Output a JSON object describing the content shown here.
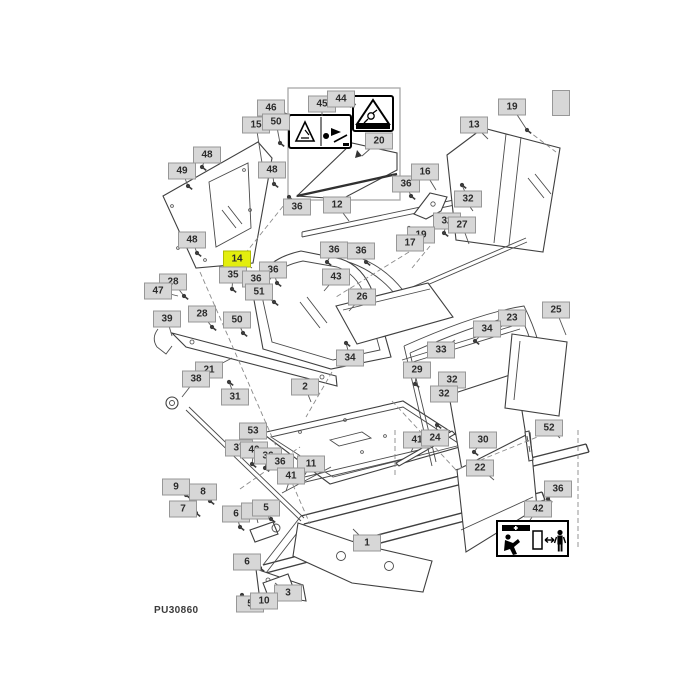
{
  "meta": {
    "part_code": "PU30860"
  },
  "colors": {
    "background": "#ffffff",
    "label_bg": "#d7d7d7",
    "label_border": "#979797",
    "label_text": "#2b2b2b",
    "highlight_bg": "#e3ee0e",
    "highlight_border": "#b2bd00"
  },
  "icons": [
    {
      "name": "pinch-point-warning-decal"
    },
    {
      "name": "rotating-parts-warning-decal"
    },
    {
      "name": "crush-hazard-warning-decal"
    },
    {
      "name": "bolt-icon"
    }
  ],
  "callouts": [
    {
      "text": "46",
      "x": 271,
      "y": 108,
      "tx": 288,
      "ty": 114,
      "kind": "part"
    },
    {
      "text": "15",
      "x": 256,
      "y": 125,
      "tx": 262,
      "ty": 163,
      "kind": "part"
    },
    {
      "text": "50",
      "x": 276,
      "y": 122,
      "tx": 280,
      "ty": 143,
      "kind": "bolt"
    },
    {
      "text": "45",
      "x": 322,
      "y": 104,
      "tx": 322,
      "ty": 116,
      "kind": "part"
    },
    {
      "text": "44",
      "x": 341,
      "y": 99,
      "tx": 356,
      "ty": 105,
      "kind": "part"
    },
    {
      "text": "20",
      "x": 379,
      "y": 141,
      "tx": 362,
      "ty": 156,
      "kind": "part"
    },
    {
      "text": "48",
      "x": 207,
      "y": 155,
      "tx": 202,
      "ty": 167,
      "kind": "bolt"
    },
    {
      "text": "49",
      "x": 182,
      "y": 171,
      "tx": 188,
      "ty": 186,
      "kind": "bolt"
    },
    {
      "text": "48",
      "x": 272,
      "y": 170,
      "tx": 274,
      "ty": 184,
      "kind": "bolt"
    },
    {
      "text": "19",
      "x": 512,
      "y": 107,
      "tx": 527,
      "ty": 130,
      "kind": "bolt"
    },
    {
      "text": "13",
      "x": 474,
      "y": 125,
      "tx": 488,
      "ty": 139,
      "kind": "part"
    },
    {
      "text": "",
      "x": 561,
      "y": 103,
      "w": 12,
      "h": 22,
      "kind": "part"
    },
    {
      "text": "48",
      "x": 192,
      "y": 240,
      "tx": 197,
      "ty": 253,
      "kind": "bolt"
    },
    {
      "text": "36",
      "x": 297,
      "y": 207,
      "tx": 289,
      "ty": 197,
      "kind": "bolt"
    },
    {
      "text": "12",
      "x": 337,
      "y": 205,
      "tx": 349,
      "ty": 221,
      "kind": "part"
    },
    {
      "text": "36",
      "x": 406,
      "y": 184,
      "tx": 411,
      "ty": 196,
      "kind": "bolt"
    },
    {
      "text": "16",
      "x": 425,
      "y": 172,
      "tx": 436,
      "ty": 190,
      "kind": "part"
    },
    {
      "text": "32",
      "x": 468,
      "y": 199,
      "tx": 462,
      "ty": 185,
      "kind": "bolt"
    },
    {
      "text": "32",
      "x": 447,
      "y": 221,
      "tx": 444,
      "ty": 233,
      "kind": "bolt"
    },
    {
      "text": "27",
      "x": 462,
      "y": 225,
      "tx": 469,
      "ty": 244,
      "kind": "part"
    },
    {
      "text": "19",
      "x": 421,
      "y": 235,
      "tx": 409,
      "ty": 228,
      "kind": "bolt"
    },
    {
      "text": "17",
      "x": 410,
      "y": 243,
      "tx": 399,
      "ty": 248,
      "kind": "part"
    },
    {
      "text": "14",
      "x": 237,
      "y": 259,
      "tx": 252,
      "ty": 268,
      "kind": "part",
      "highlight": true
    },
    {
      "text": "35",
      "x": 233,
      "y": 275,
      "tx": 232,
      "ty": 289,
      "kind": "bolt"
    },
    {
      "text": "36",
      "x": 273,
      "y": 270,
      "tx": 277,
      "ty": 283,
      "kind": "bolt"
    },
    {
      "text": "36",
      "x": 256,
      "y": 279,
      "tx": 250,
      "ty": 291,
      "kind": "bolt"
    },
    {
      "text": "28",
      "x": 173,
      "y": 282,
      "tx": 184,
      "ty": 296,
      "kind": "bolt"
    },
    {
      "text": "47",
      "x": 158,
      "y": 291,
      "tx": 178,
      "ty": 296,
      "kind": "part"
    },
    {
      "text": "51",
      "x": 259,
      "y": 292,
      "tx": 274,
      "ty": 302,
      "kind": "bolt"
    },
    {
      "text": "39",
      "x": 167,
      "y": 319,
      "tx": 172,
      "ty": 336,
      "kind": "part"
    },
    {
      "text": "28",
      "x": 202,
      "y": 314,
      "tx": 212,
      "ty": 327,
      "kind": "bolt"
    },
    {
      "text": "50",
      "x": 237,
      "y": 320,
      "tx": 243,
      "ty": 333,
      "kind": "bolt"
    },
    {
      "text": "36",
      "x": 334,
      "y": 250,
      "tx": 327,
      "ty": 262,
      "kind": "bolt"
    },
    {
      "text": "36",
      "x": 361,
      "y": 251,
      "tx": 366,
      "ty": 262,
      "kind": "bolt"
    },
    {
      "text": "43",
      "x": 336,
      "y": 277,
      "tx": 324,
      "ty": 291,
      "kind": "part"
    },
    {
      "text": "26",
      "x": 362,
      "y": 297,
      "tx": 349,
      "ty": 311,
      "kind": "part"
    },
    {
      "text": "34",
      "x": 350,
      "y": 358,
      "tx": 346,
      "ty": 343,
      "kind": "bolt"
    },
    {
      "text": "21",
      "x": 209,
      "y": 370,
      "tx": 232,
      "ty": 358,
      "kind": "part"
    },
    {
      "text": "38",
      "x": 196,
      "y": 379,
      "tx": 182,
      "ty": 397,
      "kind": "part"
    },
    {
      "text": "31",
      "x": 235,
      "y": 397,
      "tx": 229,
      "ty": 382,
      "kind": "bolt"
    },
    {
      "text": "2",
      "x": 305,
      "y": 387,
      "tx": 311,
      "ty": 402,
      "kind": "part"
    },
    {
      "text": "23",
      "x": 512,
      "y": 318,
      "tx": 497,
      "ty": 330,
      "kind": "part"
    },
    {
      "text": "34",
      "x": 487,
      "y": 329,
      "tx": 475,
      "ty": 341,
      "kind": "bolt"
    },
    {
      "text": "33",
      "x": 441,
      "y": 350,
      "tx": 455,
      "ty": 340,
      "kind": "part"
    },
    {
      "text": "29",
      "x": 417,
      "y": 370,
      "tx": 415,
      "ty": 384,
      "kind": "bolt"
    },
    {
      "text": "25",
      "x": 556,
      "y": 310,
      "tx": 566,
      "ty": 335,
      "kind": "part"
    },
    {
      "text": "32",
      "x": 452,
      "y": 380,
      "tx": 447,
      "ty": 392,
      "kind": "bolt"
    },
    {
      "text": "32",
      "x": 444,
      "y": 394,
      "tx": 452,
      "ty": 398,
      "kind": "bolt"
    },
    {
      "text": "52",
      "x": 549,
      "y": 428,
      "tx": 560,
      "ty": 438,
      "kind": "part"
    },
    {
      "text": "53",
      "x": 253,
      "y": 431,
      "tx": 250,
      "ty": 446,
      "kind": "part"
    },
    {
      "text": "37",
      "x": 239,
      "y": 448,
      "tx": 225,
      "ty": 453,
      "kind": "part"
    },
    {
      "text": "40",
      "x": 254,
      "y": 450,
      "tx": 252,
      "ty": 464,
      "kind": "bolt"
    },
    {
      "text": "36",
      "x": 268,
      "y": 456,
      "tx": 265,
      "ty": 468,
      "kind": "bolt"
    },
    {
      "text": "36",
      "x": 280,
      "y": 462,
      "tx": 288,
      "ty": 471,
      "kind": "bolt"
    },
    {
      "text": "11",
      "x": 311,
      "y": 464,
      "tx": 303,
      "ty": 478,
      "kind": "part"
    },
    {
      "text": "41",
      "x": 291,
      "y": 476,
      "tx": 286,
      "ty": 491,
      "kind": "part"
    },
    {
      "text": "9",
      "x": 176,
      "y": 487,
      "tx": 186,
      "ty": 495,
      "kind": "bolt"
    },
    {
      "text": "8",
      "x": 203,
      "y": 492,
      "tx": 210,
      "ty": 501,
      "kind": "bolt"
    },
    {
      "text": "7",
      "x": 183,
      "y": 509,
      "tx": 196,
      "ty": 513,
      "kind": "bolt"
    },
    {
      "text": "6",
      "x": 236,
      "y": 514,
      "tx": 240,
      "ty": 527,
      "kind": "bolt"
    },
    {
      "text": "4",
      "x": 255,
      "y": 511,
      "tx": 258,
      "ty": 523,
      "kind": "part"
    },
    {
      "text": "5",
      "x": 266,
      "y": 508,
      "tx": 271,
      "ty": 519,
      "kind": "bolt"
    },
    {
      "text": "41",
      "x": 417,
      "y": 440,
      "tx": 411,
      "ty": 452,
      "kind": "part"
    },
    {
      "text": "24",
      "x": 435,
      "y": 438,
      "tx": 437,
      "ty": 425,
      "kind": "bolt"
    },
    {
      "text": "30",
      "x": 483,
      "y": 440,
      "tx": 474,
      "ty": 452,
      "kind": "bolt"
    },
    {
      "text": "22",
      "x": 480,
      "y": 468,
      "tx": 494,
      "ty": 480,
      "kind": "part"
    },
    {
      "text": "1",
      "x": 367,
      "y": 543,
      "tx": 353,
      "ty": 529,
      "kind": "part"
    },
    {
      "text": "6",
      "x": 247,
      "y": 562,
      "tx": 260,
      "ty": 568,
      "kind": "bolt"
    },
    {
      "text": "3",
      "x": 288,
      "y": 593,
      "tx": 275,
      "ty": 583,
      "kind": "part"
    },
    {
      "text": "5",
      "x": 250,
      "y": 604,
      "tx": 242,
      "ty": 595,
      "kind": "bolt"
    },
    {
      "text": "10",
      "x": 264,
      "y": 601,
      "tx": 254,
      "ty": 598,
      "kind": "bolt"
    },
    {
      "text": "36",
      "x": 558,
      "y": 489,
      "tx": 548,
      "ty": 499,
      "kind": "bolt"
    },
    {
      "text": "42",
      "x": 538,
      "y": 509,
      "tx": 530,
      "ty": 520,
      "kind": "part"
    }
  ]
}
